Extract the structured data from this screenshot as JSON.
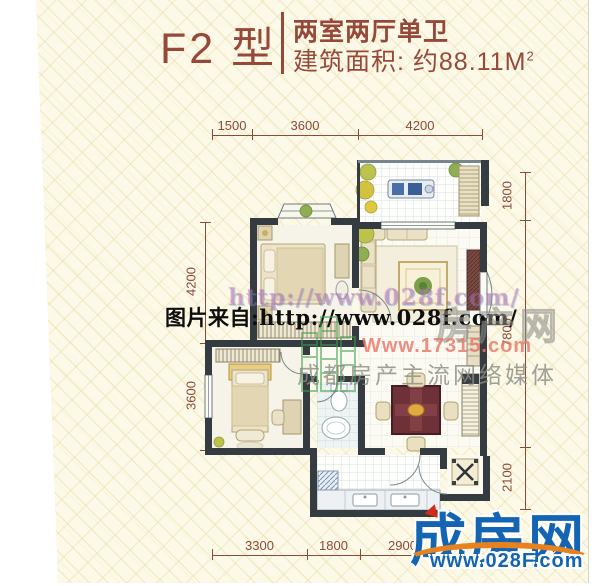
{
  "header": {
    "type_label": "F2 型",
    "layout_label": "两室两厅单卫",
    "area_label": "建筑面积: 约88.11M",
    "area_exponent": "2"
  },
  "dimensions": {
    "top": [
      "1500",
      "3600",
      "4200"
    ],
    "left": [
      "4200",
      "3600"
    ],
    "right": [
      "1800",
      "7800",
      "2100"
    ],
    "bottom": [
      "3300",
      "1800",
      "2900"
    ]
  },
  "watermarks": {
    "faint_url": "http://www.028f.com/",
    "caption": "图片来自:http://www.028f.com/",
    "brand_outline": "房产网",
    "site_url": "Www.17315.com",
    "slogan": "成都房产主流网络媒体"
  },
  "logo": {
    "title": "成房网",
    "url": "www.028F.com"
  },
  "colors": {
    "header_text": "#96493a",
    "dimension_lines": "#8a4a3c",
    "walls": "#343c42",
    "logo_blue": "#1464b4",
    "logo_orange": "#e8821e",
    "paper": "#fcf9e8"
  }
}
